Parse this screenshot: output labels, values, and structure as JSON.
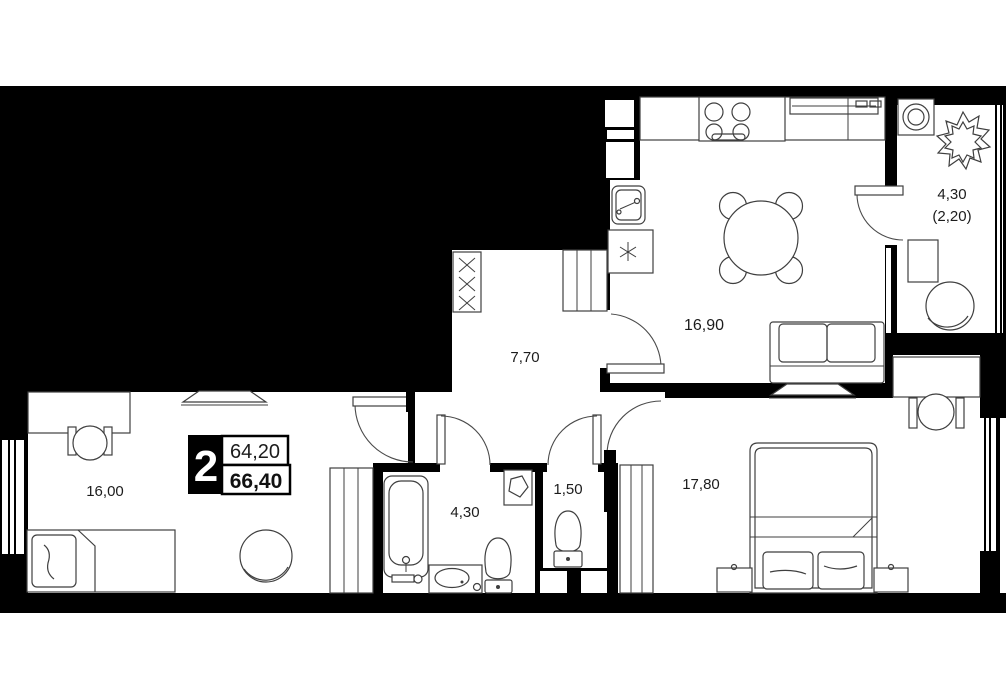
{
  "plan": {
    "title": "2-room apartment floor plan",
    "unit_badge": {
      "rooms": "2",
      "area_living": "64,20",
      "area_total": "66,40"
    },
    "rooms": [
      {
        "id": "kitchen-living",
        "area_label": "16,90"
      },
      {
        "id": "hallway",
        "area_label": "7,70"
      },
      {
        "id": "bedroom-left",
        "area_label": "16,00"
      },
      {
        "id": "bathroom",
        "area_label": "4,30"
      },
      {
        "id": "wc",
        "area_label": "1,50"
      },
      {
        "id": "bedroom-right",
        "area_label": "17,80"
      },
      {
        "id": "balcony",
        "area_label": "4,30",
        "area_label_secondary": "(2,20)"
      }
    ],
    "colors": {
      "background": "#000000",
      "floor": "#ffffff",
      "furniture_stroke": "#3f3f3f"
    }
  }
}
